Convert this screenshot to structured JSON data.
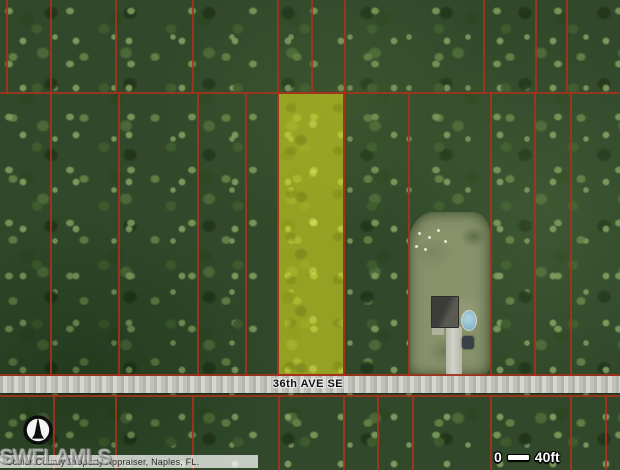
{
  "map": {
    "road_label": "36th AVE SE",
    "attribution_text": "Collier County Property Appraiser, Naples, FL.",
    "watermark_text": "SWFLAMLS",
    "scalebar": {
      "start_label": "0",
      "end_label": "40ft"
    },
    "compass": {
      "direction": "N"
    },
    "colors": {
      "parcel_line": "#a5321c",
      "highlight_fill": "rgba(230,233,30,0.55)",
      "road_fill": "#c9c9c2",
      "clearing_fill": "#87926b",
      "pool_fill": "#85b8cc"
    },
    "geometry": {
      "h_lines": [
        {
          "y": 92,
          "x1": 0,
          "x2": 620
        },
        {
          "y": 374,
          "x1": 0,
          "x2": 620
        },
        {
          "y": 395,
          "x1": 0,
          "x2": 620
        }
      ],
      "v_lines": [
        {
          "x": 6,
          "y1": 0,
          "y2": 92
        },
        {
          "x": 50,
          "y1": 0,
          "y2": 92
        },
        {
          "x": 115,
          "y1": 0,
          "y2": 92
        },
        {
          "x": 192,
          "y1": 0,
          "y2": 92
        },
        {
          "x": 277,
          "y1": 0,
          "y2": 92
        },
        {
          "x": 311,
          "y1": 0,
          "y2": 92
        },
        {
          "x": 344,
          "y1": 0,
          "y2": 92
        },
        {
          "x": 483,
          "y1": 0,
          "y2": 92
        },
        {
          "x": 535,
          "y1": 0,
          "y2": 92
        },
        {
          "x": 566,
          "y1": 0,
          "y2": 92
        },
        {
          "x": 50,
          "y1": 92,
          "y2": 375
        },
        {
          "x": 118,
          "y1": 92,
          "y2": 375
        },
        {
          "x": 197,
          "y1": 92,
          "y2": 375
        },
        {
          "x": 245,
          "y1": 92,
          "y2": 375
        },
        {
          "x": 408,
          "y1": 92,
          "y2": 375
        },
        {
          "x": 490,
          "y1": 92,
          "y2": 375
        },
        {
          "x": 534,
          "y1": 92,
          "y2": 375
        },
        {
          "x": 570,
          "y1": 92,
          "y2": 375
        },
        {
          "x": 53,
          "y1": 395,
          "y2": 470
        },
        {
          "x": 115,
          "y1": 395,
          "y2": 470
        },
        {
          "x": 192,
          "y1": 395,
          "y2": 470
        },
        {
          "x": 278,
          "y1": 395,
          "y2": 470
        },
        {
          "x": 343,
          "y1": 395,
          "y2": 470
        },
        {
          "x": 377,
          "y1": 395,
          "y2": 470
        },
        {
          "x": 412,
          "y1": 395,
          "y2": 470
        },
        {
          "x": 490,
          "y1": 395,
          "y2": 470
        },
        {
          "x": 570,
          "y1": 395,
          "y2": 470
        },
        {
          "x": 605,
          "y1": 395,
          "y2": 470
        }
      ],
      "highlight_parcel": {
        "x": 277,
        "y": 92,
        "w": 68,
        "h": 284
      },
      "road": {
        "x": 0,
        "y": 376,
        "w": 620,
        "h": 17
      },
      "clearing": {
        "x": 408,
        "y": 212,
        "w": 82,
        "h": 164
      },
      "house_roof": {
        "x": 431,
        "y": 296,
        "w": 28,
        "h": 32
      },
      "house_pad": {
        "x": 432,
        "y": 327,
        "w": 12,
        "h": 8
      },
      "pool": {
        "x": 461,
        "y": 310,
        "w": 16,
        "h": 21
      },
      "driveway": {
        "x": 446,
        "y": 326,
        "w": 16,
        "h": 66
      },
      "car": {
        "x": 462,
        "y": 336,
        "w": 12,
        "h": 13
      },
      "attribution_band": {
        "x": 0,
        "y": 455,
        "w": 258,
        "h": 13
      },
      "debris_dots": [
        [
          418,
          232
        ],
        [
          428,
          236
        ],
        [
          437,
          229
        ],
        [
          415,
          245
        ],
        [
          444,
          240
        ],
        [
          424,
          248
        ]
      ]
    }
  }
}
